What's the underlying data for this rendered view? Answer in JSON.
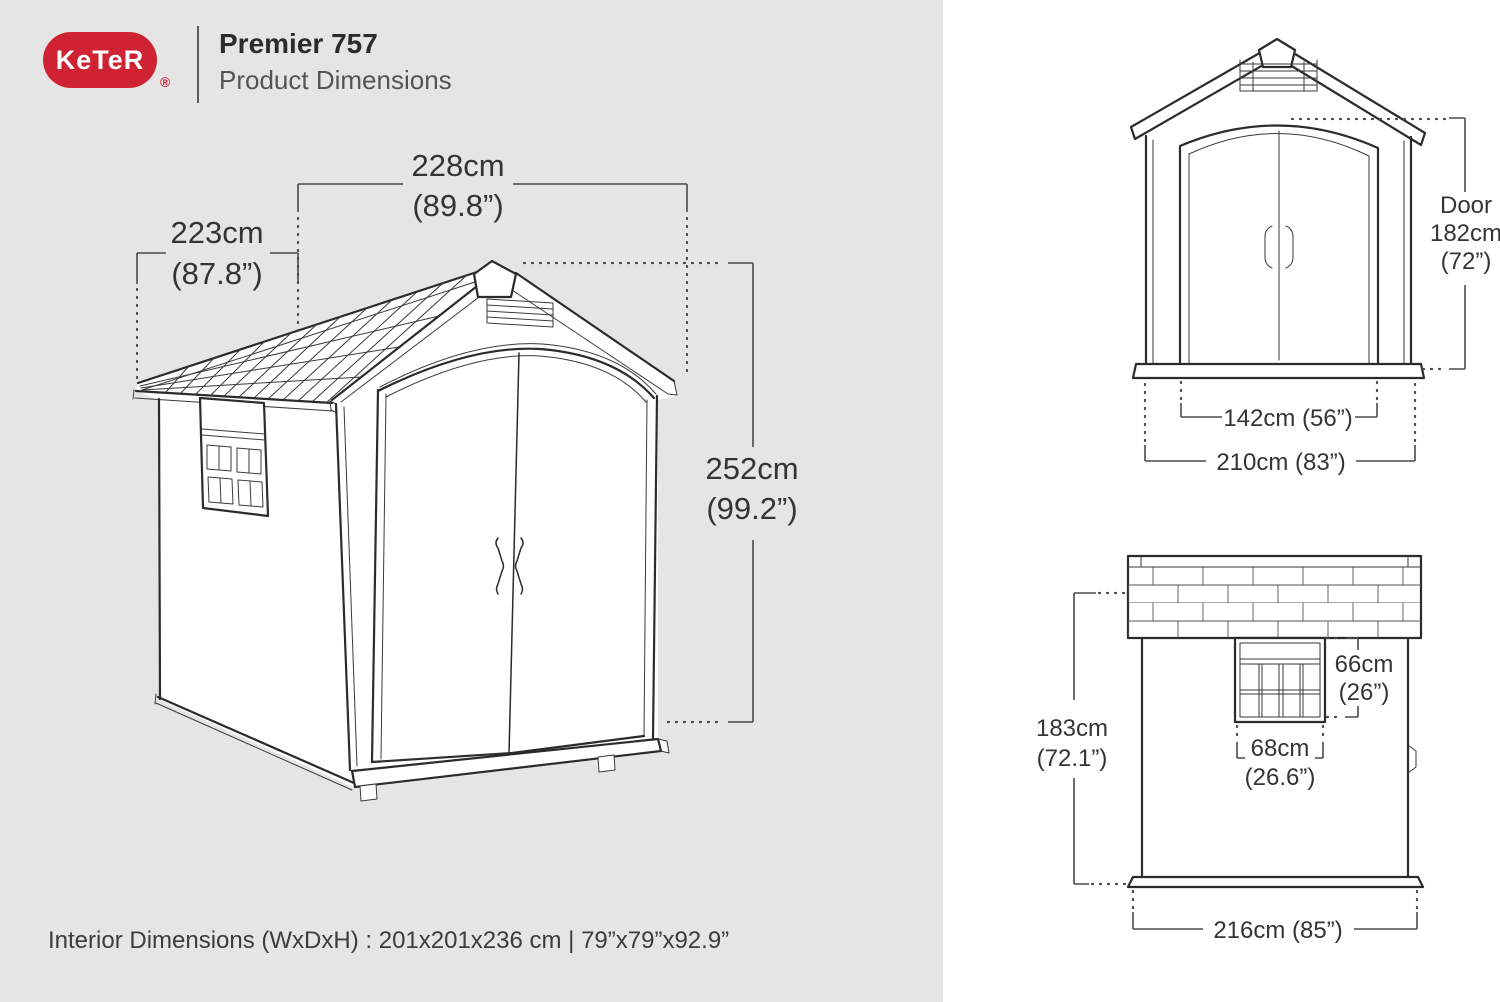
{
  "header": {
    "brand": "KeTeR",
    "registered": "®",
    "title": "Premier 757",
    "subtitle": "Product Dimensions"
  },
  "colors": {
    "brand_red": "#cf2232",
    "panel_gray": "#e6e5e5",
    "line_dark": "#2b2b2b",
    "dim_gray": "#4a4a4a"
  },
  "main_view": {
    "width_cm": "228cm",
    "width_in": "(89.8”)",
    "depth_cm": "223cm",
    "depth_in": "(87.8”)",
    "height_cm": "252cm",
    "height_in": "(99.2”)"
  },
  "front_view": {
    "door_label": "Door",
    "door_height_cm": "182cm",
    "door_height_in": "(72”)",
    "door_width": "142cm (56”)",
    "overall_width": "210cm (83”)"
  },
  "side_view": {
    "wall_height_cm": "183cm",
    "wall_height_in": "(72.1”)",
    "window_height_cm": "66cm",
    "window_height_in": "(26”)",
    "window_width_cm": "68cm",
    "window_width_in": "(26.6”)",
    "overall_width": "216cm (85”)"
  },
  "footer": {
    "interior_note": "Interior Dimensions (WxDxH) : 201x201x236 cm | 79”x79”x92.9”"
  }
}
